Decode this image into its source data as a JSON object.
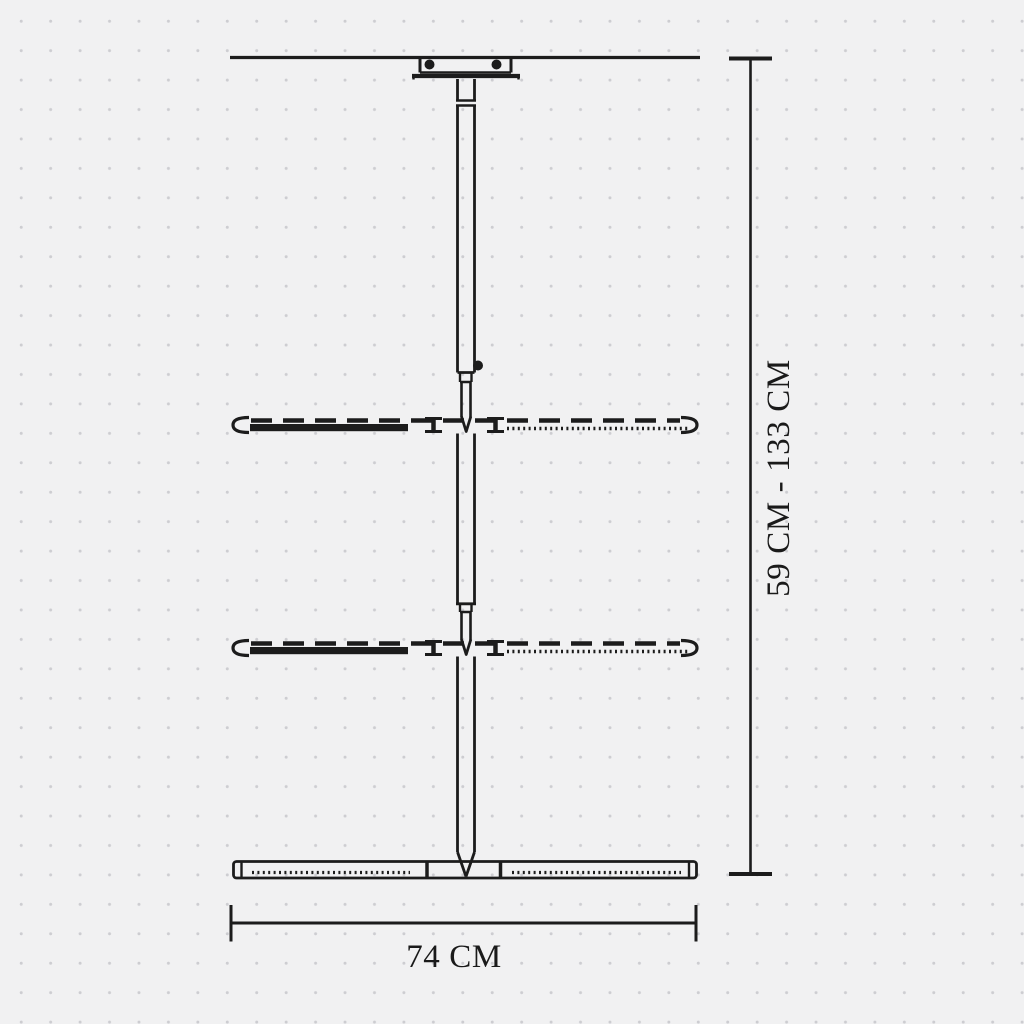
{
  "colors": {
    "background": "#f1f1f2",
    "dots": "#cdcdd1",
    "ink": "#1c1c1c"
  },
  "diagram": {
    "type": "technical dimension drawing",
    "height_dimension": "59 CM - 133 CM",
    "width_dimension": "74 CM"
  }
}
